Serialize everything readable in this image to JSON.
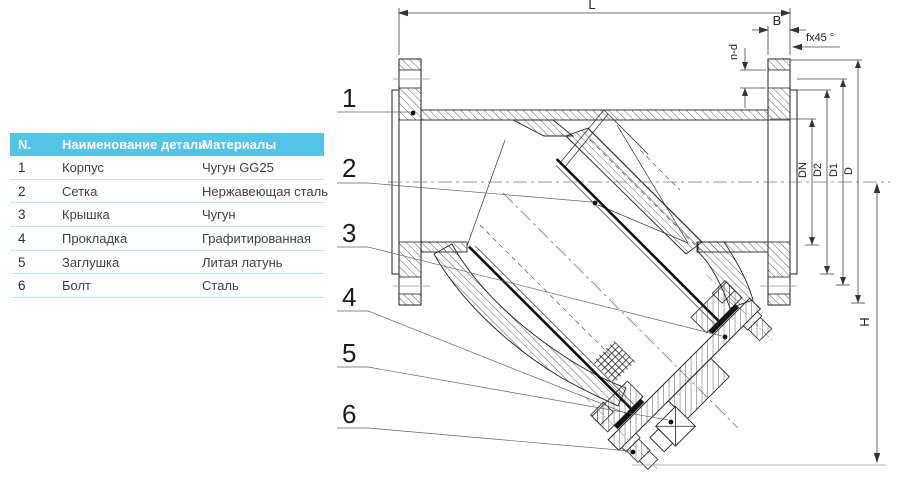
{
  "table": {
    "headers": {
      "n": "N.",
      "name": "Наименование детали",
      "material": "Материалы"
    },
    "rows": [
      {
        "n": "1",
        "name": "Корпус",
        "material": "Чугун  GG25"
      },
      {
        "n": "2",
        "name": "Сетка",
        "material": "Нержавеющая сталь"
      },
      {
        "n": "3",
        "name": "Крышка",
        "material": "Чугун"
      },
      {
        "n": "4",
        "name": "Прокладка",
        "material": "Графитированная"
      },
      {
        "n": "5",
        "name": "Заглушка",
        "material": "Литая латунь"
      },
      {
        "n": "6",
        "name": "Болт",
        "material": "Сталь"
      }
    ],
    "colors": {
      "header_bg": "#55c2e7",
      "header_text": "#ffffff",
      "row_divider": "#bfe6f5",
      "row_text": "#3f3f3f"
    }
  },
  "drawing": {
    "callouts": [
      "1",
      "2",
      "3",
      "4",
      "5",
      "6"
    ],
    "dimensions": {
      "length": "L",
      "flange_thickness": "B",
      "bolt_holes": "n-d",
      "chamfer": "fx45 °",
      "nominal_bore": "DN",
      "raised_face": "D2",
      "bolt_circle": "D1",
      "flange_od": "D",
      "height": "H"
    },
    "line_color": "#333333"
  }
}
